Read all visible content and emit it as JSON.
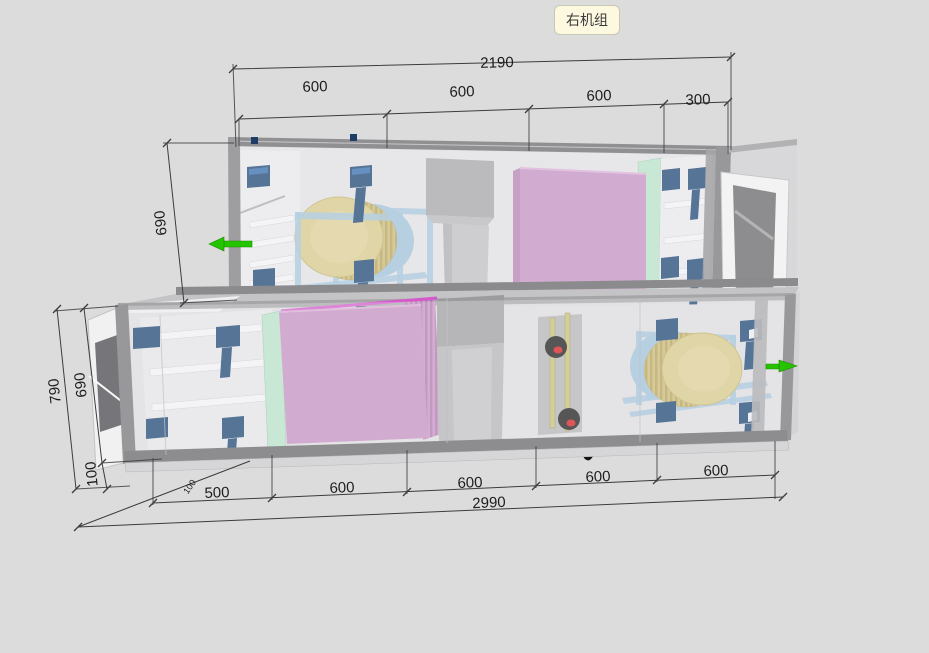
{
  "badge": {
    "label": "右机组"
  },
  "dimensions": {
    "top": {
      "total": "2190",
      "segments": [
        "600",
        "600",
        "600",
        "300"
      ]
    },
    "upper_left": {
      "height": "690"
    },
    "lower_left": {
      "overall": "790",
      "inner": "690",
      "base": "100"
    },
    "bottom": {
      "segments": [
        "500",
        "600",
        "600",
        "600",
        "600"
      ],
      "total": "2990",
      "base_offset": "100"
    }
  },
  "colors": {
    "bg": "#dcdcdc",
    "ink": "#1c1c1c",
    "dimline": "#3c3c3c",
    "badge_bg": "#fcf9e0",
    "badge_border": "#c9c9b2",
    "pink": "#c48fc0",
    "magenta": "#d557cb",
    "mint": "#b7e3c6",
    "tan": "#d8c985",
    "light_blue": "#9dc1d9",
    "dark_blue": "#143e6e",
    "green": "#25c400",
    "tube_yellow": "#c6c06f",
    "valve_red": "#d91414"
  },
  "model": {
    "description": "two-tier air handling unit 3d view",
    "airflow_arrows": [
      {
        "side": "upper-left",
        "direction": "left"
      },
      {
        "side": "lower-right",
        "direction": "right"
      }
    ]
  }
}
